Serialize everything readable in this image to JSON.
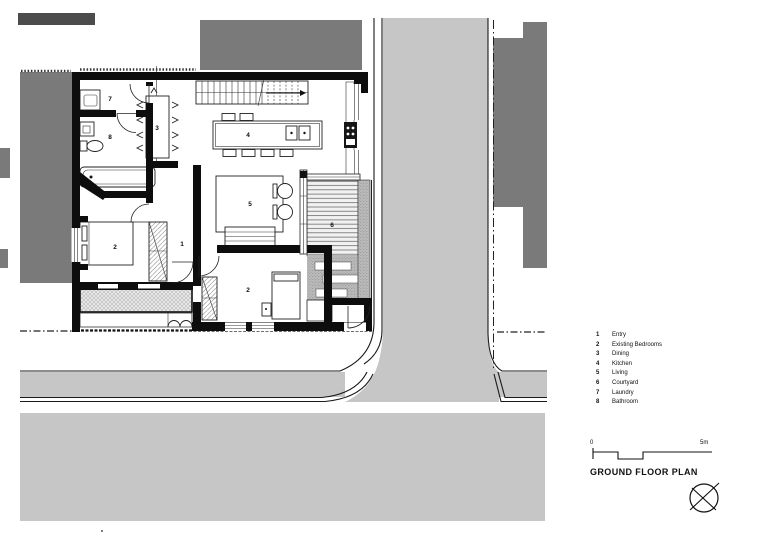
{
  "colors": {
    "paper": "#ffffff",
    "neighbor": "#7a7a7a",
    "neighbor-dark": "#4c4c4c",
    "road": "#c6c6c6",
    "wall": "#0d0d0d"
  },
  "title_block": {
    "title": "GROUND FLOOR PLAN",
    "scale_start": "0",
    "scale_end": "5m"
  },
  "legend": {
    "items": [
      {
        "num": "1",
        "label": "Entry"
      },
      {
        "num": "2",
        "label": "Existing Bedrooms"
      },
      {
        "num": "3",
        "label": "Dining"
      },
      {
        "num": "4",
        "label": "Kitchen"
      },
      {
        "num": "5",
        "label": "Living"
      },
      {
        "num": "6",
        "label": "Courtyard"
      },
      {
        "num": "7",
        "label": "Laundry"
      },
      {
        "num": "8",
        "label": "Bathroom"
      }
    ]
  },
  "plan": {
    "labels": [
      {
        "num": "7"
      },
      {
        "num": "8"
      },
      {
        "num": "3"
      },
      {
        "num": "4"
      },
      {
        "num": "5"
      },
      {
        "num": "6"
      },
      {
        "num": "1"
      },
      {
        "num": "2"
      },
      {
        "num": "2"
      }
    ]
  }
}
